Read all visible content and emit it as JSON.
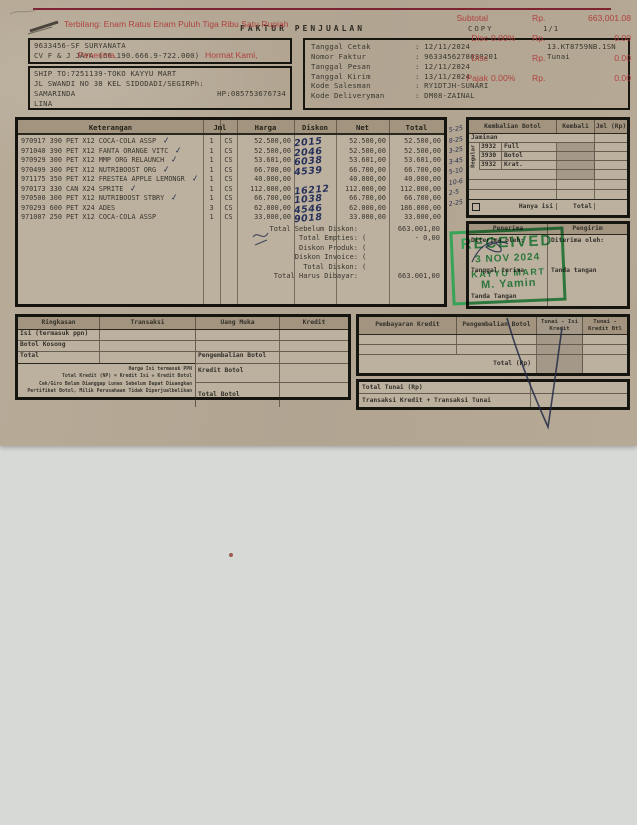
{
  "header": {
    "title": "FAKTUR PENJUALAN",
    "copy_label": "COPY",
    "page": "1/1"
  },
  "customer": {
    "line1": "9633456-SF SURYANATA",
    "line2": "CV F & J JAYA (66.190.666.9-722.000)",
    "ship_to": "SHIP TO:7251139-TOKO KAYYU MART",
    "address": "JL SWANDI NO 38 KEL SIDODADI/SEGIRPh:",
    "city": "SAMARINDA",
    "phone": "HP:085753676734",
    "note": "LINA"
  },
  "invoice_info": {
    "rows": [
      {
        "label": "Tanggal Cetak",
        "value": ": 12/11/2024",
        "extra": "13.KT8759NB.1SN"
      },
      {
        "label": "Nomor Faktur",
        "value": ": 9633456278630201",
        "extra": "Tunai"
      },
      {
        "label": "Tanggal Pesan",
        "value": ": 12/11/2024",
        "extra": ""
      },
      {
        "label": "Tanggal Kirim",
        "value": ": 13/11/2024",
        "extra": ""
      },
      {
        "label": "Kode Salesman",
        "value": ": RY1DTJH-SUNARI",
        "extra": ""
      },
      {
        "label": "Kode Deliveryman",
        "value": ": DM08-ZAINAL",
        "extra": ""
      }
    ]
  },
  "items_table": {
    "headers": {
      "keterangan": "Keterangan",
      "jml": "Jml",
      "harga": "Harga",
      "diskon": "Diskon",
      "net": "Net",
      "total": "Total"
    },
    "items": [
      {
        "desc": "970917 390 PET X12 COCA-COLA ASSP",
        "check": "✓",
        "qty": "1",
        "unit": "CS",
        "harga": "52.500,00",
        "diskon_hand": "2015",
        "net": "52.500,00",
        "total": "52.500,00"
      },
      {
        "desc": "971040 390 PET X12 FANTA ORANGE VITC",
        "check": "✓",
        "qty": "1",
        "unit": "CS",
        "harga": "52.500,00",
        "diskon_hand": "2046",
        "net": "52.500,00",
        "total": "52.500,00"
      },
      {
        "desc": "970929 300 PET X12 MMP ORG RELAUNCH",
        "check": "✓",
        "qty": "1",
        "unit": "CS",
        "harga": "53.601,00",
        "diskon_hand": "6038",
        "net": "53.601,00",
        "total": "53.601,00"
      },
      {
        "desc": "970499 300 PET X12 NUTRIBOOST ORG",
        "check": "✓",
        "qty": "1",
        "unit": "CS",
        "harga": "66.700,00",
        "diskon_hand": "4539",
        "net": "66.700,00",
        "total": "66.700,00"
      },
      {
        "desc": "971175 350 PET X12 FRESTEA APPLE LEMONGR",
        "check": "✓",
        "qty": "1",
        "unit": "CS",
        "harga": "40.000,00",
        "diskon_hand": "",
        "net": "40.000,00",
        "total": "40.000,00"
      },
      {
        "desc": "970173 330 CAN X24 SPRITE",
        "check": "✓",
        "qty": "1",
        "unit": "CS",
        "harga": "112.000,00",
        "diskon_hand": "16212",
        "net": "112.000,00",
        "total": "112.000,00"
      },
      {
        "desc": "970500 300 PET X12 NUTRIBOOST STBRY",
        "check": "✓",
        "qty": "1",
        "unit": "CS",
        "harga": "66.700,00",
        "diskon_hand": "1038",
        "net": "66.700,00",
        "total": "66.700,00"
      },
      {
        "desc": "970293 600 PET X24 ADES",
        "check": "",
        "qty": "3",
        "unit": "CS",
        "harga": "62.000,00",
        "diskon_hand": "4546",
        "net": "62.000,00",
        "total": "186.000,00"
      },
      {
        "desc": "971007 250 PET X12 COCA-COLA ASSP",
        "check": "",
        "qty": "1",
        "unit": "CS",
        "harga": "33.000,00",
        "diskon_hand": "9018",
        "net": "33.000,00",
        "total": "33.000,00"
      }
    ],
    "totals": [
      {
        "label": "Total Sebelum Diskon:",
        "open": "",
        "value": "663.001,00"
      },
      {
        "label": "Total Empties:",
        "open": "(",
        "value": "- 0,00"
      },
      {
        "label": "Diskon Produk:",
        "open": "(",
        "value": ""
      },
      {
        "label": "Diskon Invoice:",
        "open": "(",
        "value": ""
      },
      {
        "label": "Total Diskon:",
        "open": "(",
        "value": ""
      },
      {
        "label": "Total Harus Dibayar:",
        "open": "",
        "value": "663.001,00"
      }
    ],
    "margin_scribbles": [
      "5-25",
      "8-25",
      "3-25",
      "3-45",
      "5-10",
      "10-6",
      "2-5",
      "2-25"
    ]
  },
  "bottle_panel": {
    "headers": [
      "Kembalian Botol",
      "Kembali",
      "Jml (Rp)"
    ],
    "jaminan_label": "Jaminan",
    "group_label": "Regular",
    "rows": [
      {
        "code": "3932",
        "name": "Full"
      },
      {
        "code": "3930",
        "name": "Botol"
      },
      {
        "code": "3932",
        "name": "Krat."
      }
    ],
    "footer": {
      "hanya_isi": "Hanya isi",
      "total": "Total"
    }
  },
  "receiver_box": {
    "left_header": "Penerima",
    "right_header": "Pengirim",
    "left": {
      "received_by": "Diterima oleh:",
      "date_label": "Tanggal terima",
      "sign_label": "Tanda Tangan"
    },
    "right": {
      "received_by": "Diterima oleh:",
      "sign_label": "Tanda tangan"
    }
  },
  "stamp": {
    "line1": "RECEIVED",
    "date": "3 NOV 2024",
    "store": "KAYYU MART",
    "name": "M. Yamin",
    "color": "#2ba351"
  },
  "summary_box": {
    "headers": [
      "Ringkasan",
      "Transaksi",
      "Uang Muka",
      "Kredit"
    ],
    "rows": [
      "Isi (termasuk ppn)",
      "Botol Kosong",
      "Total"
    ],
    "right_rows": [
      "Pengembalian Botol",
      "Kredit Botol",
      "Total Botol"
    ],
    "fine_print": [
      "Harga Isi termasuk PPN",
      "Total Kredit (NP) = Kredit Isi + Kredit Botol",
      "Cek/Giro Belum Dianggap Lunas Sebelum Dapat Diuangkan",
      "Pertifikat Botol, Milik Perusahaan Tidak Diperjualbelikan"
    ]
  },
  "credit_box": {
    "headers": [
      "Pembayaran Kredit",
      "Pengembalian Botol",
      "Tunai - Isi Kredit",
      "Tunai - Kredit Btl"
    ],
    "total_label": "Total (Rp)",
    "total_tunai_label": "Total Tunai (Rp)",
    "transaksi_label": "Transaksi Kredit + Transaksi Tunai"
  },
  "footer_print": {
    "terbilang": "Terbilang: Enam Ratus Enam Puluh Tiga Ribu Satu Rupiah",
    "penerima": "Penerima,",
    "hormat": "Hormat Kami,",
    "rows": [
      {
        "label": "Subtotal",
        "pct": "",
        "rp": "Rp.",
        "value": "663,001.08"
      },
      {
        "label": "Disc",
        "pct": "0.00%",
        "rp": "Rp.",
        "value": "0.00"
      },
      {
        "label": "Disc",
        "pct": "",
        "rp": "Rp.",
        "value": "0.00"
      },
      {
        "label": "Pajak",
        "pct": "0.00%",
        "rp": "Rp.",
        "value": "0.00"
      }
    ],
    "accent_color": "#b0413e"
  }
}
